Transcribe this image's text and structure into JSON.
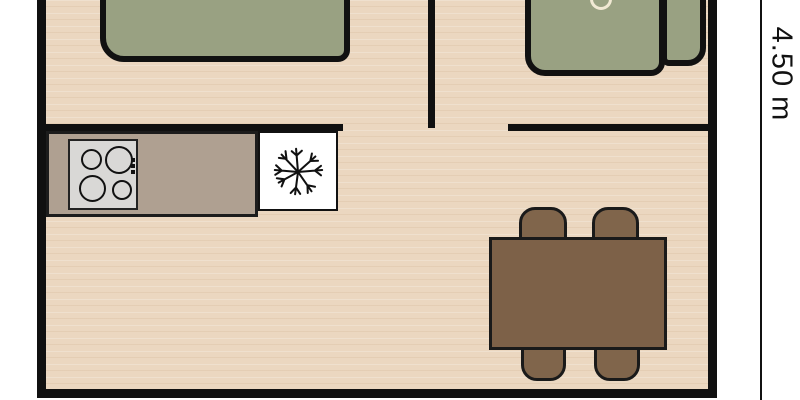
{
  "dimension": {
    "label": "4.50 m"
  },
  "colors": {
    "floor": "#ebd7c0",
    "wall": "#101010",
    "outline": "#111111",
    "furniture_green": "#99a182",
    "counter": "#afa091",
    "stove": "#d9d8d6",
    "fridge": "#ffffff",
    "table_brown": "#7d6148",
    "chair_brown": "#80654b",
    "cushion_ring": "#f1e9d4",
    "background": "#ffffff",
    "dim_color": "#111111"
  },
  "furniture": {
    "bed": "double-bed",
    "sofa": "sofa-with-armrest",
    "counter": "kitchen-counter",
    "stove": {
      "name": "cooktop",
      "burners": 4
    },
    "fridge": {
      "name": "refrigerator",
      "icon": "snowflake-icon"
    },
    "table": {
      "name": "dining-table",
      "chairs": 4
    }
  }
}
